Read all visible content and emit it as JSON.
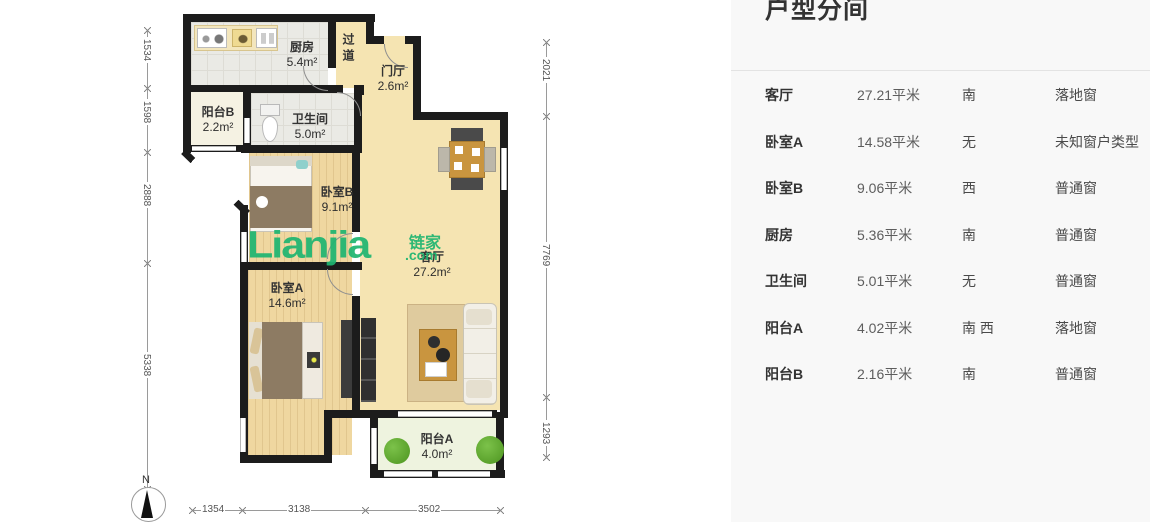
{
  "panel": {
    "title": "户型分间",
    "rows": [
      {
        "name": "客厅",
        "area": "27.21平米",
        "orient": "南",
        "window": "落地窗"
      },
      {
        "name": "卧室A",
        "area": "14.58平米",
        "orient": "无",
        "window": "未知窗户类型"
      },
      {
        "name": "卧室B",
        "area": "9.06平米",
        "orient": "西",
        "window": "普通窗"
      },
      {
        "name": "厨房",
        "area": "5.36平米",
        "orient": "南",
        "window": "普通窗"
      },
      {
        "name": "卫生间",
        "area": "5.01平米",
        "orient": "无",
        "window": "普通窗"
      },
      {
        "name": "阳台A",
        "area": "4.02平米",
        "orient": "南 西",
        "window": "落地窗"
      },
      {
        "name": "阳台B",
        "area": "2.16平米",
        "orient": "南",
        "window": "普通窗"
      }
    ]
  },
  "floorplan": {
    "watermark": {
      "text": "Lianjia",
      "cn": "链家",
      "suffix": ".com",
      "color": "#1fb571"
    },
    "compass_label": "N",
    "rooms": [
      {
        "label": "厨房",
        "area": "5.4m²"
      },
      {
        "label": "过道",
        "area": ""
      },
      {
        "label": "门厅",
        "area": "2.6m²"
      },
      {
        "label": "阳台B",
        "area": "2.2m²"
      },
      {
        "label": "卫生间",
        "area": "5.0m²"
      },
      {
        "label": "卧室B",
        "area": "9.1m²"
      },
      {
        "label": "客厅",
        "area": "27.2m²"
      },
      {
        "label": "卧室A",
        "area": "14.6m²"
      },
      {
        "label": "阳台A",
        "area": "4.0m²"
      }
    ],
    "dims": {
      "left": [
        "1534",
        "1598",
        "2888",
        "5338"
      ],
      "right": [
        "2021",
        "7769",
        "1293"
      ],
      "bottom": [
        "1354",
        "3138",
        "3502"
      ]
    }
  }
}
